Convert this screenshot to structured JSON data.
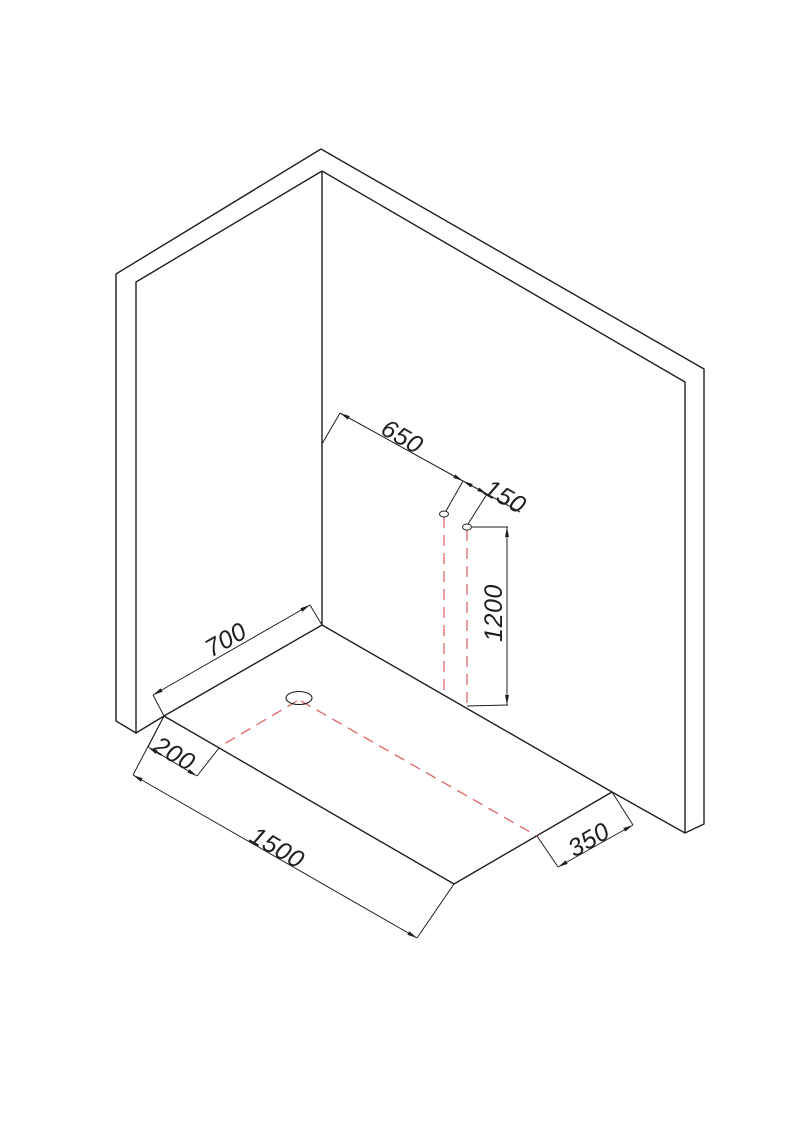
{
  "canvas": {
    "width": 793,
    "height": 1121,
    "background": "#ffffff"
  },
  "style": {
    "outline_color": "#1f1f1f",
    "outline_width": 1.4,
    "dim_color": "#1f1f1f",
    "dim_width": 1,
    "waste_color": "#e06666",
    "waste_width": 1.3,
    "waste_dash": "11 7",
    "font_size": 25,
    "arrow_len": 10,
    "arrow_halfwidth": 2
  },
  "structure": {
    "left_wall": [
      [
        321,
        149
      ],
      [
        116,
        274
      ],
      [
        116,
        721
      ],
      [
        136,
        733
      ],
      [
        136,
        282
      ],
      [
        322,
        171
      ]
    ],
    "right_wall": [
      [
        321,
        149
      ],
      [
        704,
        369
      ],
      [
        704,
        824
      ],
      [
        685,
        833
      ],
      [
        685,
        382
      ],
      [
        322,
        171
      ]
    ],
    "corner_edge": [
      [
        322,
        171
      ],
      [
        322,
        625
      ]
    ],
    "wall_base_left": [
      [
        136,
        733
      ],
      [
        164,
        716
      ]
    ],
    "wall_base_right": [
      [
        612,
        792
      ],
      [
        685,
        833
      ]
    ],
    "tray_outline": [
      [
        164,
        716
      ],
      [
        322,
        625
      ],
      [
        612,
        792
      ],
      [
        454,
        884
      ]
    ]
  },
  "drain": {
    "cx": 299,
    "cy": 698,
    "rx": 13,
    "ry": 6.5
  },
  "pipes": [
    {
      "name": "wall-pipe-1",
      "cx": 444,
      "cy": 514,
      "rx": 4.5,
      "ry": 3
    },
    {
      "name": "wall-pipe-2",
      "cx": 467,
      "cy": 527,
      "rx": 4.5,
      "ry": 3
    }
  ],
  "waste_lines": [
    {
      "name": "waste-pipe1-drop",
      "from": [
        444,
        517
      ],
      "to": [
        444,
        694
      ]
    },
    {
      "name": "waste-pipe2-drop",
      "from": [
        467,
        530
      ],
      "to": [
        467,
        707
      ]
    },
    {
      "name": "waste-floor-run",
      "from": [
        301,
        701
      ],
      "to": [
        537,
        836
      ]
    },
    {
      "name": "waste-floor-branch",
      "from": [
        297,
        701
      ],
      "to": [
        219,
        747
      ]
    }
  ],
  "dimensions": [
    {
      "label": "650",
      "line": [
        [
          340,
          413
        ],
        [
          463,
          481
        ]
      ],
      "ext": [
        [
          [
            322,
            444
          ],
          [
            340,
            413
          ]
        ],
        [
          [
            463,
            481
          ],
          [
            446,
            511
          ]
        ]
      ],
      "text": {
        "x": 402,
        "y": 437,
        "angle": 30
      }
    },
    {
      "label": "150",
      "line": [
        [
          463,
          481
        ],
        [
          487,
          494
        ]
      ],
      "tail": [
        [
          487,
          494
        ],
        [
          520,
          512
        ]
      ],
      "ext": [
        [
          [
            487,
            494
          ],
          [
            468,
            524
          ]
        ]
      ],
      "text": {
        "x": 505,
        "y": 497,
        "angle": 30
      }
    },
    {
      "label": "1200",
      "line": [
        [
          507,
          527
        ],
        [
          507,
          705
        ]
      ],
      "ext": [
        [
          [
            472,
            527
          ],
          [
            508,
            527
          ]
        ],
        [
          [
            467,
            706
          ],
          [
            508,
            705
          ]
        ]
      ],
      "text": {
        "x": 494,
        "y": 613,
        "angle": -90
      }
    },
    {
      "label": "700",
      "line": [
        [
          153,
          695
        ],
        [
          310,
          605
        ]
      ],
      "ext": [
        [
          [
            164,
            716
          ],
          [
            153,
            695
          ]
        ],
        [
          [
            322,
            625
          ],
          [
            310,
            605
          ]
        ]
      ],
      "text": {
        "x": 226,
        "y": 640,
        "angle": -30
      }
    },
    {
      "label": "200",
      "line": [
        [
          148,
          747
        ],
        [
          197,
          776
        ]
      ],
      "ext": [
        [
          [
            164,
            716
          ],
          [
            148,
            747
          ]
        ],
        [
          [
            219,
            748
          ],
          [
            197,
            776
          ]
        ]
      ],
      "text": {
        "x": 174,
        "y": 754,
        "angle": 30
      }
    },
    {
      "label": "1500",
      "line": [
        [
          133,
          775
        ],
        [
          417,
          938
        ]
      ],
      "ext": [
        [
          [
            164,
            716
          ],
          [
            133,
            775
          ]
        ],
        [
          [
            454,
            884
          ],
          [
            417,
            938
          ]
        ]
      ],
      "text": {
        "x": 277,
        "y": 848,
        "angle": 30
      }
    },
    {
      "label": "350",
      "line": [
        [
          558,
          867
        ],
        [
          633,
          825
        ]
      ],
      "ext": [
        [
          [
            537,
            836
          ],
          [
            558,
            867
          ]
        ],
        [
          [
            612,
            792
          ],
          [
            633,
            825
          ]
        ]
      ],
      "text": {
        "x": 589,
        "y": 840,
        "angle": -30
      }
    }
  ]
}
